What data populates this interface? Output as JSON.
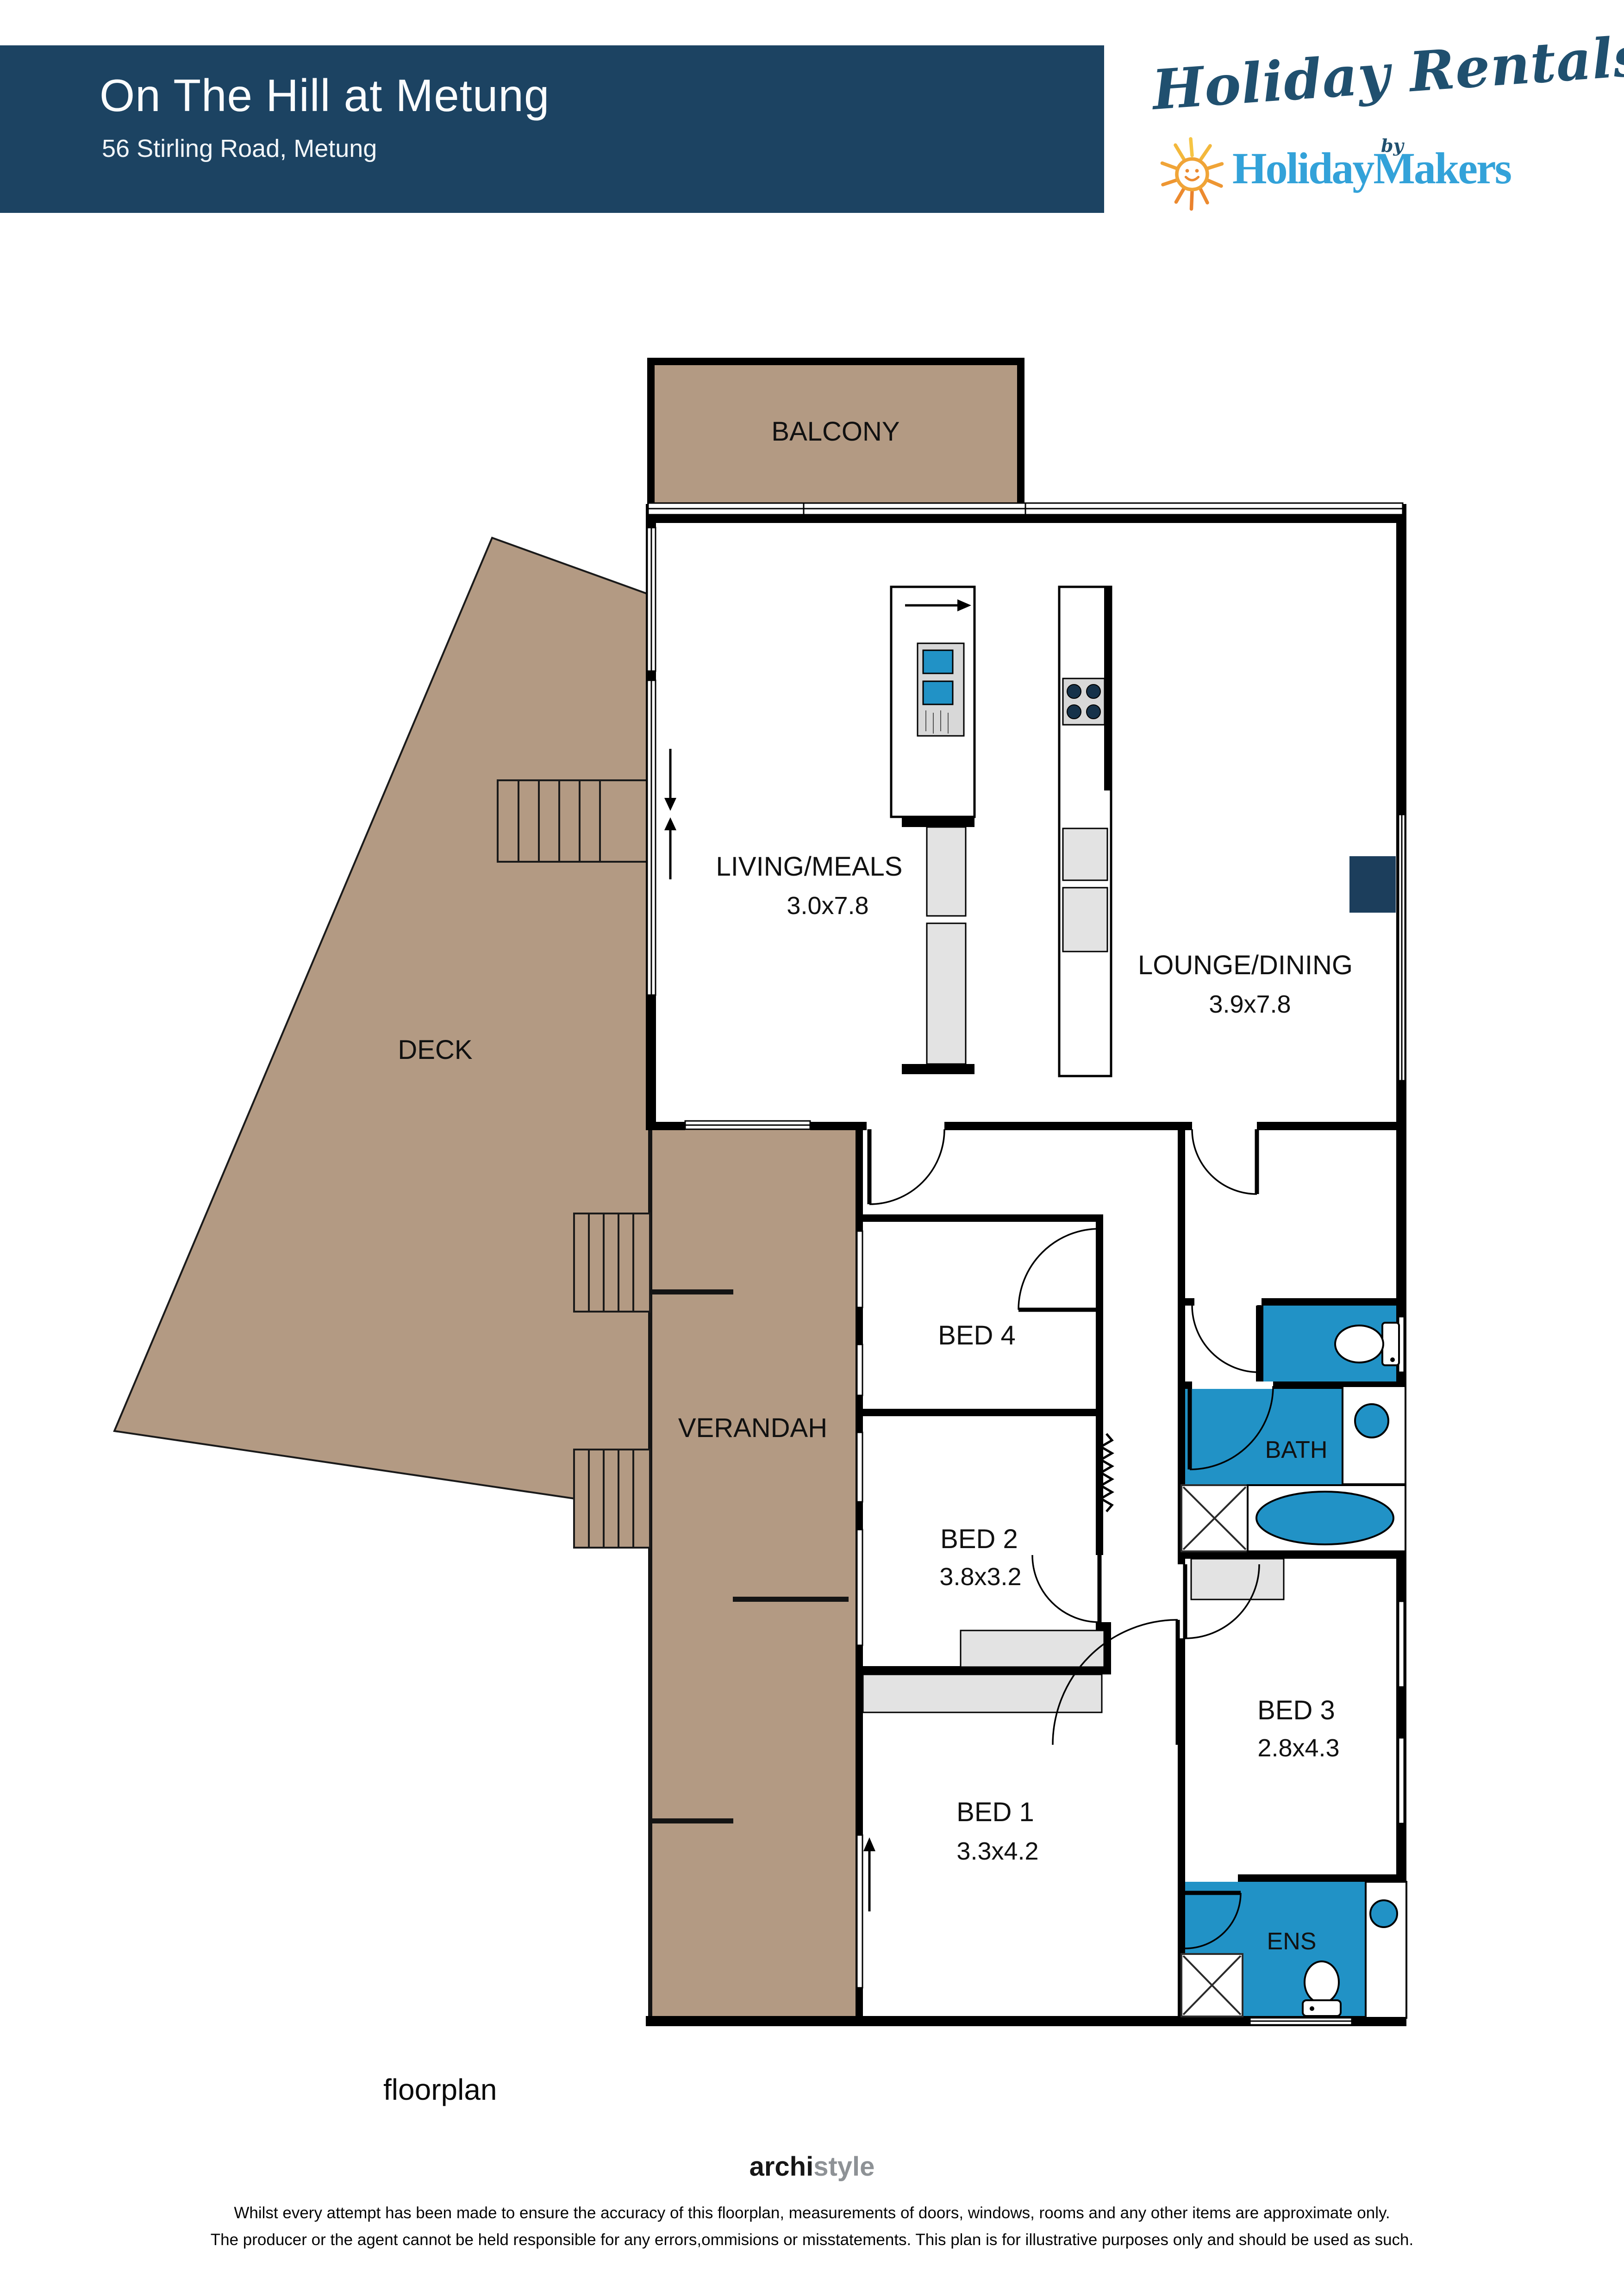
{
  "header": {
    "title": "On The Hill at Metung",
    "address": "56 Stirling Road, Metung"
  },
  "logo": {
    "script": "Holiday Rentals",
    "by": "by",
    "brand": "HolidayMakers",
    "sun_icon": "smiling-sun"
  },
  "plan": {
    "rooms": {
      "balcony": {
        "label": "BALCONY"
      },
      "living": {
        "label": "LIVING/MEALS",
        "dims": "3.0x7.8"
      },
      "lounge": {
        "label": "LOUNGE/DINING",
        "dims": "3.9x7.8"
      },
      "deck": {
        "label": "DECK"
      },
      "verandah": {
        "label": "VERANDAH"
      },
      "bed4": {
        "label": "BED 4"
      },
      "bed2": {
        "label": "BED 2",
        "dims": "3.8x3.2"
      },
      "bed3": {
        "label": "BED 3",
        "dims": "2.8x4.3"
      },
      "bed1": {
        "label": "BED 1",
        "dims": "3.3x4.2"
      },
      "bath": {
        "label": "BATH"
      },
      "ens": {
        "label": "ENS"
      }
    }
  },
  "footer": {
    "caption": "floorplan",
    "brand_primary": "archi",
    "brand_secondary": "style",
    "disclaimer_line1": "Whilst every attempt has been made to ensure the accuracy of this floorplan, measurements of doors, windows, rooms and any other items are approximate only.",
    "disclaimer_line2": "The producer or the agent cannot be held responsible for any errors,ommisions or misstatements. This plan is for illustrative purposes only and should be used as such."
  },
  "colors": {
    "header_navy": "#1c4362",
    "logo_navy": "#20506f",
    "logo_blue": "#33a2d9",
    "sun_yellow": "#f6c544",
    "sun_orange": "#ee8c2f",
    "timber_brown": "#b39a83",
    "fixture_blue": "#2192c6",
    "wall_black": "#000000",
    "cabinet_grey": "#e3e3e3",
    "accent_navy_square": "#1c3e5c"
  }
}
